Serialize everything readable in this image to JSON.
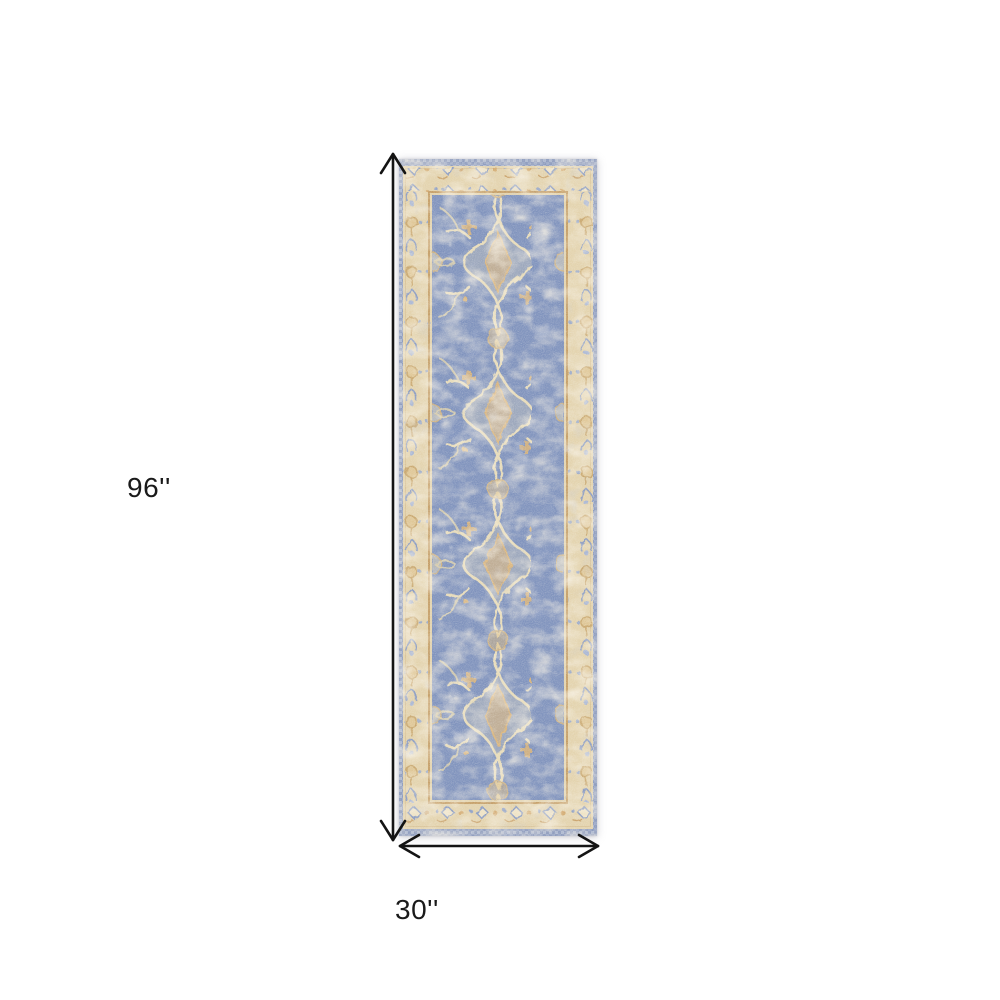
{
  "diagram": {
    "type": "product-dimension-diagram",
    "product": "runner rug",
    "height_label": "96''",
    "width_label": "30''",
    "arrow_color": "#141414",
    "label_color": "#1a1a1a",
    "background": "#ffffff"
  },
  "rug": {
    "description": "distressed vintage-style runner rug, blue field with cream and gold ornaments",
    "colors": {
      "edge_band": "#8e9cbe",
      "edge_check_light": "#ccd3e2",
      "border": "#e3d3ae",
      "border_light": "#ecdfc2",
      "frame_line": "#c59f68",
      "field": "#8093bd",
      "ornament_cream": "#e7dbb9",
      "ornament_gold": "#d6b27a",
      "ornament_blue": "#8b9cc2"
    }
  }
}
